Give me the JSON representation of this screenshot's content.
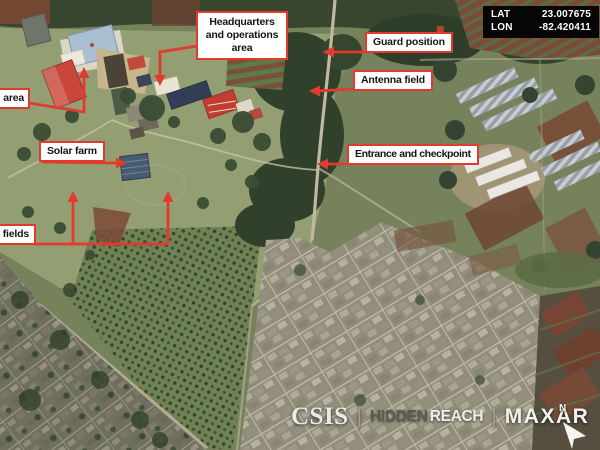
{
  "coordinates": {
    "lat_label": "LAT",
    "lat_value": "23.007675",
    "lon_label": "LON",
    "lon_value": "-82.420411"
  },
  "annotations": {
    "headquarters": {
      "label": "Headquarters and operations area"
    },
    "guard_position": {
      "label": "Guard position"
    },
    "antenna_field": {
      "label": "Antenna field"
    },
    "area_partial": {
      "label": "area"
    },
    "solar_farm": {
      "label": "Solar farm"
    },
    "entrance_checkpoint": {
      "label": "Entrance and checkpoint"
    },
    "fields_partial": {
      "label": "fields"
    }
  },
  "credits": {
    "csis": "CSIS",
    "separator": "|",
    "hidden_reach_dark": "HIDDEN",
    "hidden_reach_light": "REACH",
    "maxar": "MAXAR"
  },
  "compass": {
    "north_label": "N"
  },
  "colors": {
    "annotation_red": "#e23a2e",
    "label_bg": "#ffffff",
    "label_text": "#141414",
    "coord_box_bg": "#060606",
    "coord_text": "#ffffff"
  }
}
